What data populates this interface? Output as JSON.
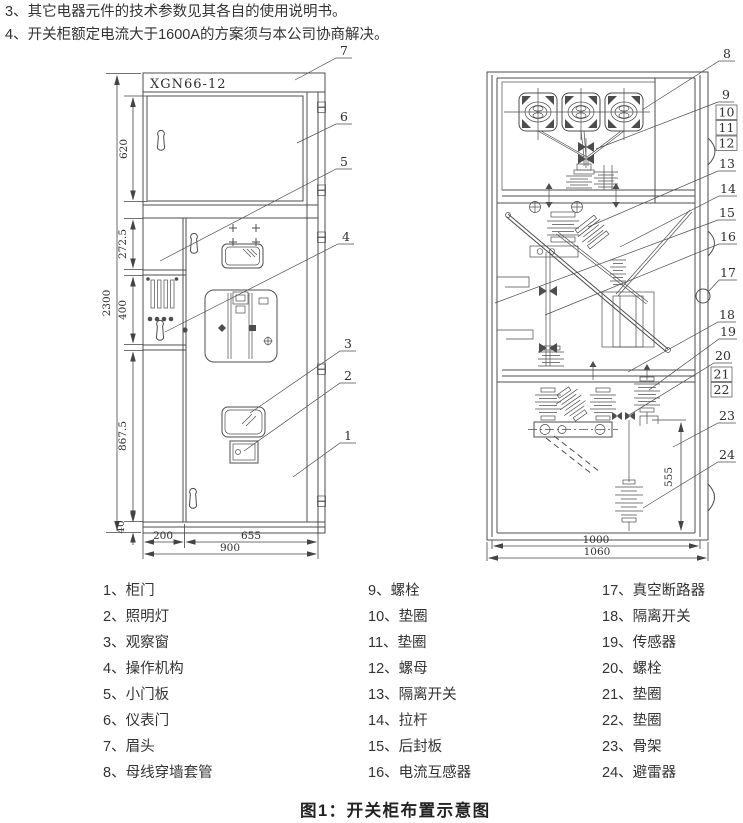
{
  "notes": [
    "3、其它电器元件的技术参数见其各自的使用说明书。",
    "4、开关柜额定电流大于1600A的方案须与本公司协商解决。"
  ],
  "caption": "图1：开关柜布置示意图",
  "front_view": {
    "model_label": "XGN66-12",
    "dims": {
      "total_height": "2300",
      "sec1": "620",
      "sec2": "272.5",
      "sec3": "400",
      "sec4": "867.5",
      "sec5": "40",
      "w_left": "200",
      "w_right": "655",
      "w_total": "900"
    },
    "callouts": {
      "c1": "1",
      "c2": "2",
      "c3": "3",
      "c4": "4",
      "c5": "5",
      "c6": "6",
      "c7": "7"
    }
  },
  "side_view": {
    "dims": {
      "arrester_height": "555",
      "w_inner": "1000",
      "w_total": "1060"
    },
    "callouts": {
      "c8": "8",
      "c9": "9",
      "c10": "10",
      "c11": "11",
      "c12": "12",
      "c13": "13",
      "c14": "14",
      "c15": "15",
      "c16": "16",
      "c17": "17",
      "c18": "18",
      "c19": "19",
      "c20": "20",
      "c21": "21",
      "c22": "22",
      "c23": "23",
      "c24": "24"
    }
  },
  "legend": {
    "columns": [
      [
        "1、柜门",
        "2、照明灯",
        "3、观察窗",
        "4、操作机构",
        "5、小门板",
        "6、仪表门",
        "7、眉头",
        "8、母线穿墙套管"
      ],
      [
        "9、螺栓",
        "10、垫圈",
        "11、垫圈",
        "12、螺母",
        "13、隔离开关",
        "14、拉杆",
        "15、后封板",
        "16、电流互感器"
      ],
      [
        "17、真空断路器",
        "18、隔离开关",
        "19、传感器",
        "20、螺栓",
        "21、垫圈",
        "22、垫圈",
        "23、骨架",
        "24、避雷器"
      ]
    ]
  }
}
